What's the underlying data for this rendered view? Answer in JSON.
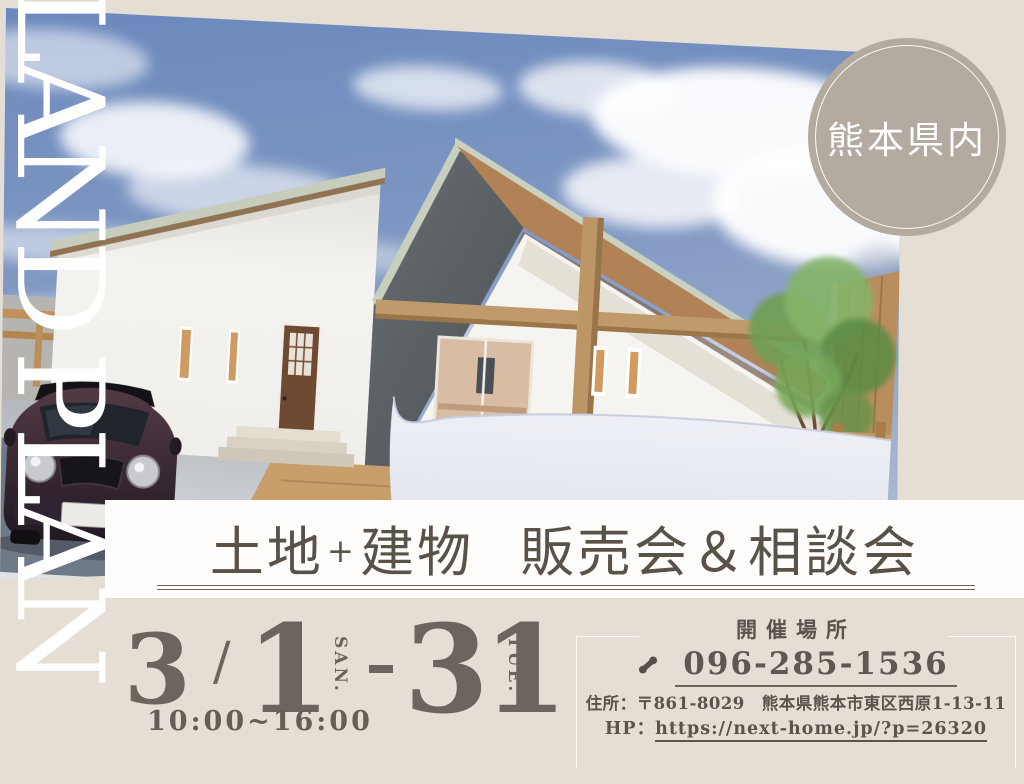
{
  "banner": {
    "text": "LAND PLAN"
  },
  "badge": {
    "text": "熊本県内",
    "bg_color": "#b3aba0"
  },
  "title_band": {
    "parts": [
      "土地",
      "+",
      "建物",
      "販売会＆相談会"
    ],
    "text_color": "#5a5249",
    "underline_color": "#6b635c"
  },
  "schedule": {
    "month": "3",
    "separator": "/",
    "start_day": "1",
    "start_dow": "SAN.",
    "end_day": "31",
    "end_dow": "TUE.",
    "hours": "10:00~16:00",
    "text_color": "#6c645d"
  },
  "venue": {
    "heading": "開催場所",
    "phone": "096-285-1536",
    "address_label": "住所：",
    "address": "〒861-8029　熊本県熊本市東区西原1-13-11",
    "hp_label": "HP：",
    "url": "https://next-home.jp/?p=26320"
  },
  "colors": {
    "background_beige": "#e5ded5",
    "band_white": "#fefdfc",
    "sky_blue": "#7b93c0",
    "wood": "#bd9666",
    "dark_wall": "#5b6065",
    "car_maroon": "#3f2b33"
  }
}
